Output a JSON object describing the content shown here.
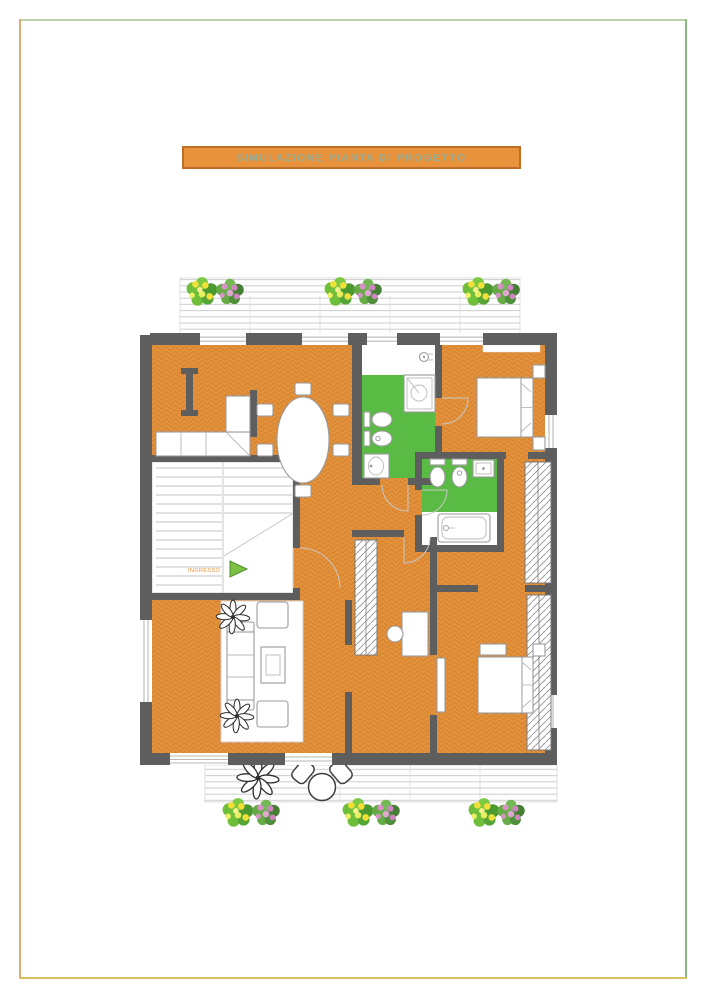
{
  "frame": {
    "top_color": "#b7d3a9",
    "left_color": "#ddaa71",
    "right_color": "#83bb7e",
    "bottom_color": "#d9c05e"
  },
  "title_bar": {
    "label": "SIMULAZIONE PIANTA DI PROGETTO",
    "bg_color": "#e8923c",
    "border_color": "#bb6f27",
    "text_color": "#9aab92"
  },
  "plan": {
    "entrance_label": "INGRESSO",
    "colors": {
      "floor_orange": "#e4913c",
      "floor_orange_line": "#cd7b28",
      "bathroom_green": "#5abb44",
      "wall_gray": "#5e5e5e",
      "deck_line": "#cdcdcd",
      "entrance_arrow_green": "#7cc143",
      "entrance_text_orange": "#e8923c"
    },
    "icons": [
      "entrance-arrow-icon",
      "shrub-icon",
      "flower-shrub-icon",
      "potted-plant-icon",
      "boiler-icon",
      "shower-icon",
      "toilet-icon",
      "bidet-icon",
      "sink-icon",
      "bathtub-icon"
    ]
  }
}
